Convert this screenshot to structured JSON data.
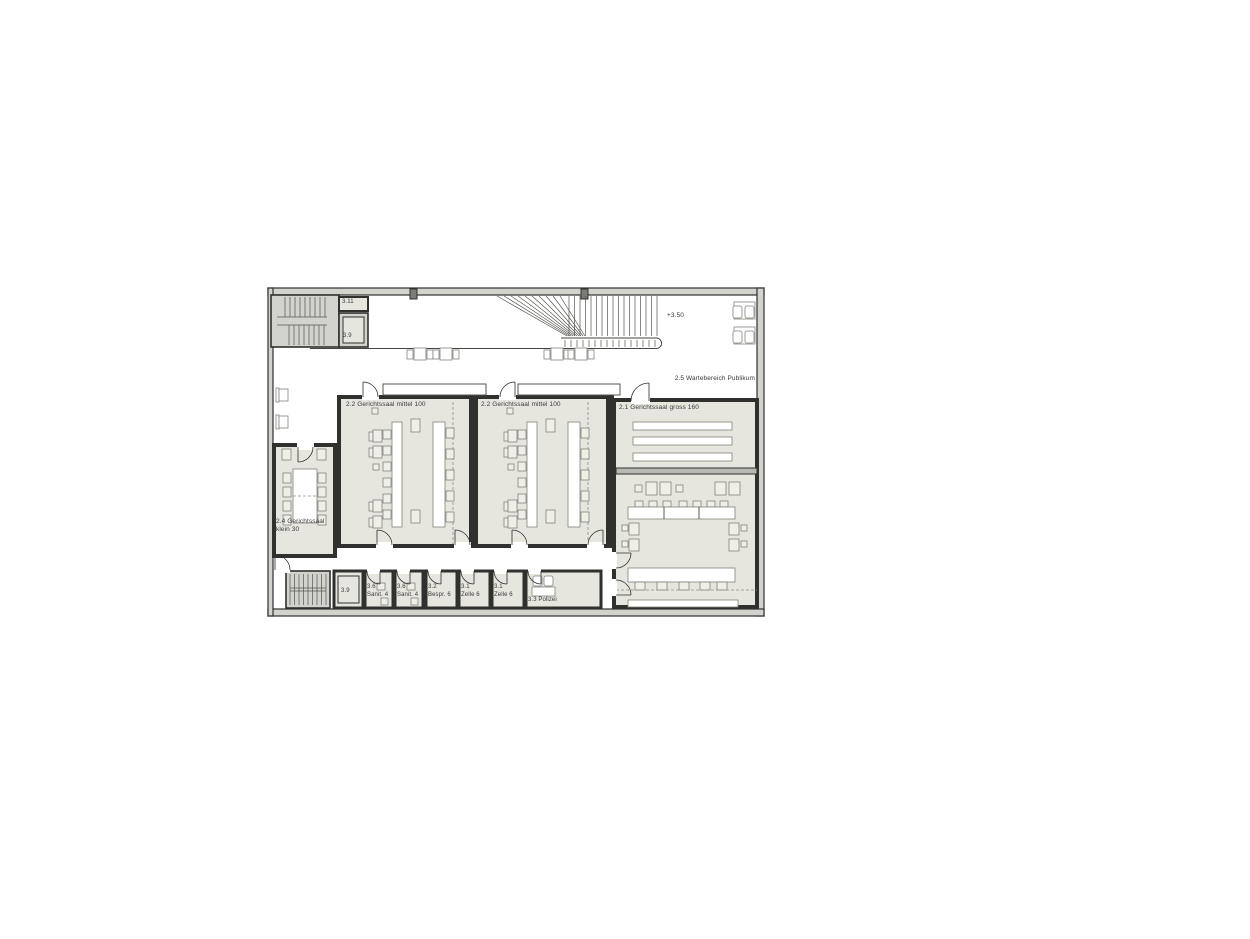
{
  "colors": {
    "floor": "#e6e6de",
    "wall_fill": "#d3d3cd",
    "wall_line": "#30302e",
    "furn_fill": "#efefe8",
    "furn_line": "#82827c",
    "tread_line": "#55554f",
    "dash": "#8e8e88",
    "text": "#3a3a3a",
    "post": "#7c7c76",
    "barrier": "#b9b9b3",
    "glass_line": "#55554f",
    "rail": "#45453f"
  },
  "labels": {
    "r311": "3.11",
    "r39_upper": "3.9",
    "level": "+3.50",
    "waiting": "2.5 Wartebereich Publikum",
    "mittel_a": "2.2 Gerichtssaal mittel 100",
    "mittel_b": "2.2 Gerichtssaal mittel 100",
    "gross": "2.1 Gerichtssaal gross 160",
    "klein_1": "2.4 Gerichtssaal",
    "klein_2": "klein 30",
    "r39_lower": "3.9",
    "sanit_a_1": "3.6",
    "sanit_a_2": "Sanit. 4",
    "sanit_b_1": "3.6",
    "sanit_b_2": "Sanit. 4",
    "bespr_1": "3.2",
    "bespr_2": "Bespr. 6",
    "zelle_a_1": "3.1",
    "zelle_a_2": "Zelle 6",
    "zelle_b_1": "3.1",
    "zelle_b_2": "Zelle 6",
    "polizei": "3.3 Polizei"
  }
}
